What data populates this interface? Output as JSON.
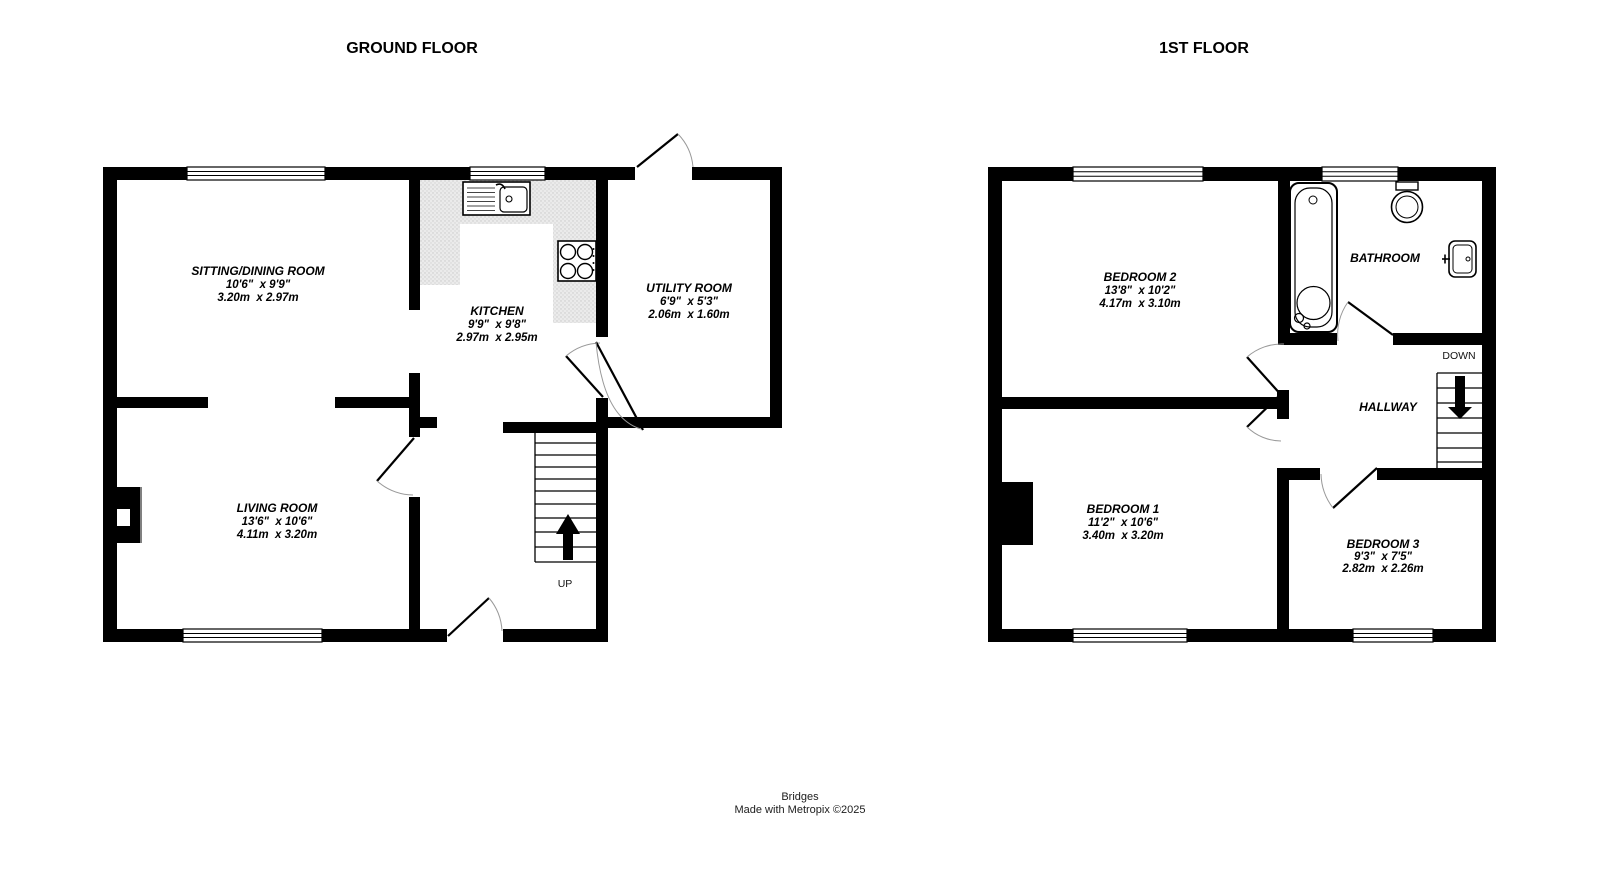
{
  "ground_floor": {
    "title": "GROUND FLOOR",
    "rooms": {
      "sitting_dining": {
        "name": "SITTING/DINING ROOM",
        "imperial": "10'6\"  x 9'9\"",
        "metric": "3.20m  x 2.97m"
      },
      "kitchen": {
        "name": "KITCHEN",
        "imperial": "9'9\"  x 9'8\"",
        "metric": "2.97m  x 2.95m"
      },
      "utility": {
        "name": "UTILITY ROOM",
        "imperial": "6'9\"  x 5'3\"",
        "metric": "2.06m  x 1.60m"
      },
      "living": {
        "name": "LIVING ROOM",
        "imperial": "13'6\"  x 10'6\"",
        "metric": "4.11m  x 3.20m"
      }
    },
    "stairs_label": "UP"
  },
  "first_floor": {
    "title": "1ST FLOOR",
    "rooms": {
      "bedroom2": {
        "name": "BEDROOM 2",
        "imperial": "13'8\"  x 10'2\"",
        "metric": "4.17m  x 3.10m"
      },
      "bathroom": {
        "name": "BATHROOM"
      },
      "hallway": {
        "name": "HALLWAY"
      },
      "bedroom1": {
        "name": "BEDROOM 1",
        "imperial": "11'2\"  x 10'6\"",
        "metric": "3.40m  x 3.20m"
      },
      "bedroom3": {
        "name": "BEDROOM 3",
        "imperial": "9'3\"  x 7'5\"",
        "metric": "2.82m  x 2.26m"
      }
    },
    "stairs_label": "DOWN"
  },
  "footer": {
    "line1": "Bridges",
    "line2": "Made with Metropix ©2025"
  },
  "colors": {
    "wall": "#000000",
    "counter": "#e9e9e9",
    "background": "#ffffff",
    "door_swing": "#999999"
  }
}
